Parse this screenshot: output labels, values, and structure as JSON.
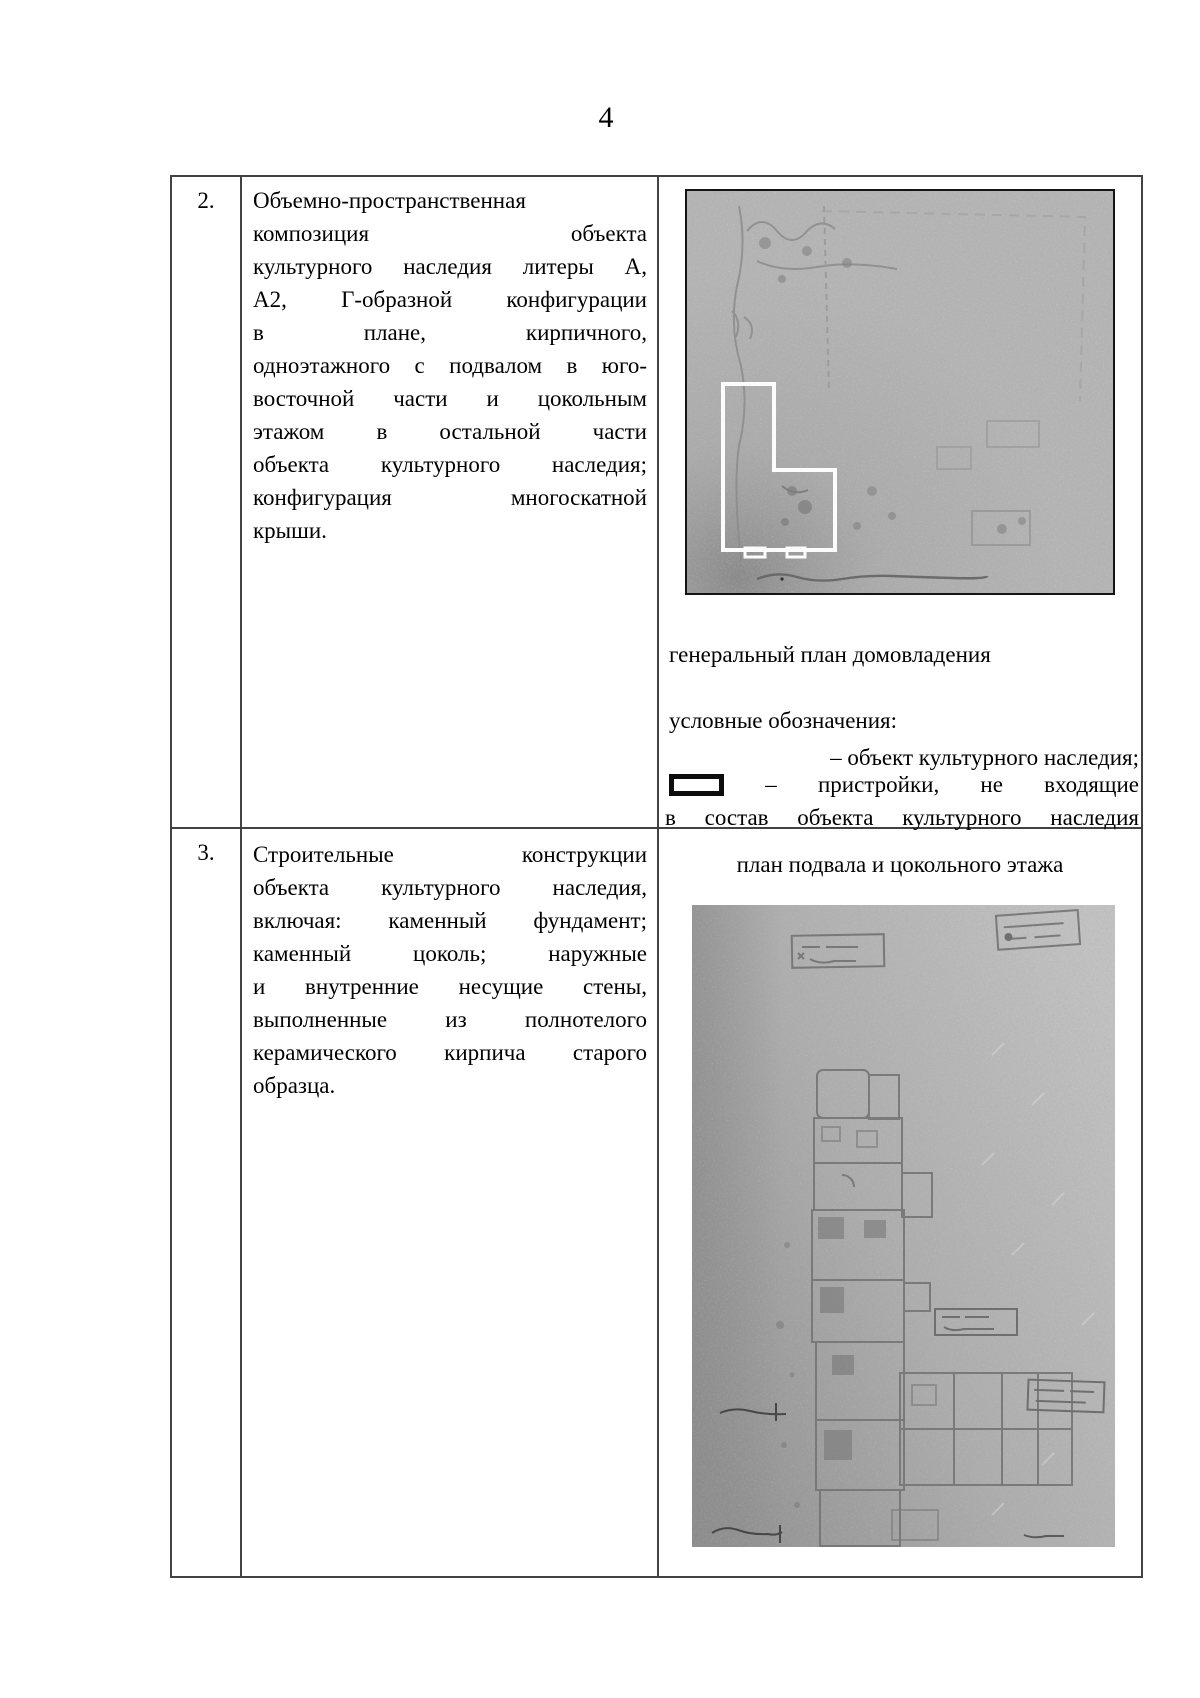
{
  "page_number": "4",
  "rows": [
    {
      "num": "2.",
      "lines": [
        "Объемно-пространственная",
        "композиция объекта",
        "культурного наследия литеры А,",
        "А2, Г-образной конфигурации",
        "в плане, кирпичного,",
        "одноэтажного с подвалом в юго-",
        "восточной части и цокольным",
        "этажом в остальной части",
        "объекта культурного наследия;",
        "конфигурация многоскатной",
        "крыши."
      ],
      "caption": "генеральный план домовладения",
      "legend": {
        "title": "условные обозначения:",
        "item1": "– объект культурного наследия;",
        "item2_line1": "– пристройки, не входящие",
        "item2_line2": "в состав объекта культурного наследия"
      }
    },
    {
      "num": "3.",
      "lines": [
        "Строительные конструкции",
        "объекта культурного наследия,",
        "включая: каменный фундамент;",
        "каменный цоколь; наружные",
        "и внутренние несущие стены,",
        "выполненные из полнотелого",
        "керамического кирпича старого",
        "образца."
      ],
      "caption": "план подвала и цокольного этажа"
    }
  ],
  "colors": {
    "table_border": "#424242",
    "scan_gray": "#b4b4b4",
    "heritage_outline": "#fcfcfc",
    "annex_symbol": "#0d0d0d"
  }
}
